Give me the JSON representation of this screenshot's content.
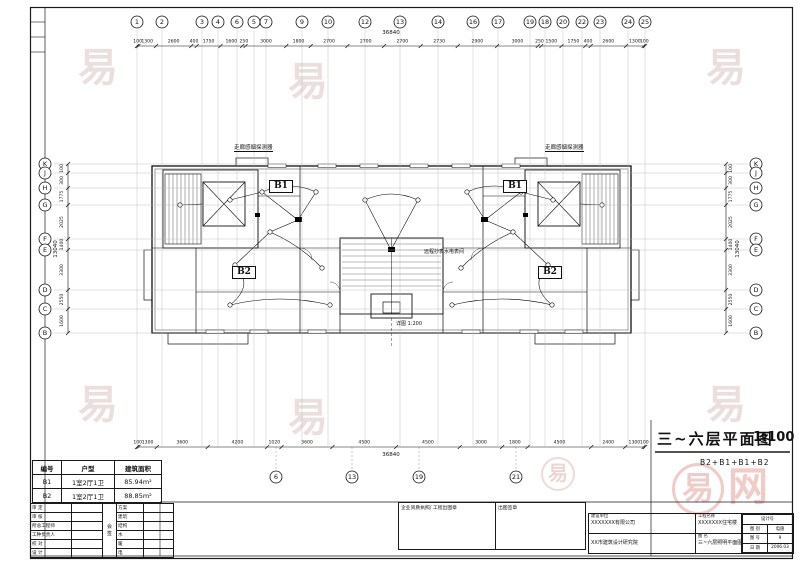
{
  "title": {
    "main": "三~六层平面图",
    "scale": "1:100",
    "subtitle": "B2+B1+B1+B2"
  },
  "grid": {
    "top_labels": [
      "1",
      "2",
      "3",
      "4",
      "6",
      "5",
      "7",
      "9",
      "10",
      "12",
      "13",
      "14",
      "16",
      "17",
      "19",
      "18",
      "20",
      "22",
      "23",
      "24",
      "25"
    ],
    "top_dims": [
      "100",
      "1300",
      "2600",
      "400",
      "1750",
      "1600",
      "250",
      "3000",
      "1800",
      "2700",
      "2700",
      "2700",
      "2730",
      "2900",
      "3000",
      "250",
      "1500",
      "1750",
      "400",
      "2600",
      "1300",
      "100"
    ],
    "top_total": "36840",
    "bottom_dims": [
      "100",
      "1300",
      "3600",
      "4200",
      "1020",
      "3600",
      "4500",
      "4500",
      "3000",
      "1800",
      "4500",
      "2400",
      "1300",
      "100"
    ],
    "bottom_total": "36840",
    "bottom_labels": [
      "6",
      "13",
      "19",
      "21"
    ],
    "side_labels": [
      "K",
      "J",
      "H",
      "G",
      "F",
      "E",
      "D",
      "C",
      "B"
    ],
    "side_dims": [
      "100",
      "300",
      "1775",
      "2025",
      "1400",
      "3300",
      "2550",
      "1600"
    ],
    "side_total": "13040"
  },
  "plan": {
    "units": [
      "B1",
      "B1",
      "B2",
      "B2"
    ],
    "notes": [
      "走廊感烟探测器",
      "走廊感烟探测器",
      "远程抄表水电表间",
      "详图 1:200"
    ]
  },
  "legend": {
    "headers": [
      "编号",
      "户型",
      "建筑面积"
    ],
    "rows": [
      [
        "B1",
        "1室2厅1卫",
        "85.94m²"
      ],
      [
        "B2",
        "1室2厅1卫",
        "88.85m²"
      ]
    ]
  },
  "sign": {
    "left": [
      "审 定",
      "审 核",
      "所总工程师",
      "工种负责人",
      "校 对",
      "设 计"
    ],
    "middle": [
      "会",
      "签"
    ],
    "right": [
      "方案",
      "建筑",
      "结构",
      "水",
      "暖",
      "电"
    ]
  },
  "stamps": {
    "left": "企业资质执照/ 工程出图章",
    "right": "出图签章"
  },
  "titleblock": {
    "owner_label": "建设单位",
    "owner": "XXXXXXX有限公司",
    "designer": "XX市建筑设计研究院",
    "project_label": "工程名称",
    "project": "XXXXXXX住宅楼",
    "sheetname_label": "图 名",
    "sheetname": "三~六层照明平面图",
    "design_no_label": "设计号",
    "cat_label": "图 别",
    "cat": "电施",
    "no_label": "图 号",
    "no": "9",
    "date_label": "日 期",
    "date": "2006.03"
  },
  "watermark": {
    "glyph": "易",
    "brand_suffix": "网"
  }
}
